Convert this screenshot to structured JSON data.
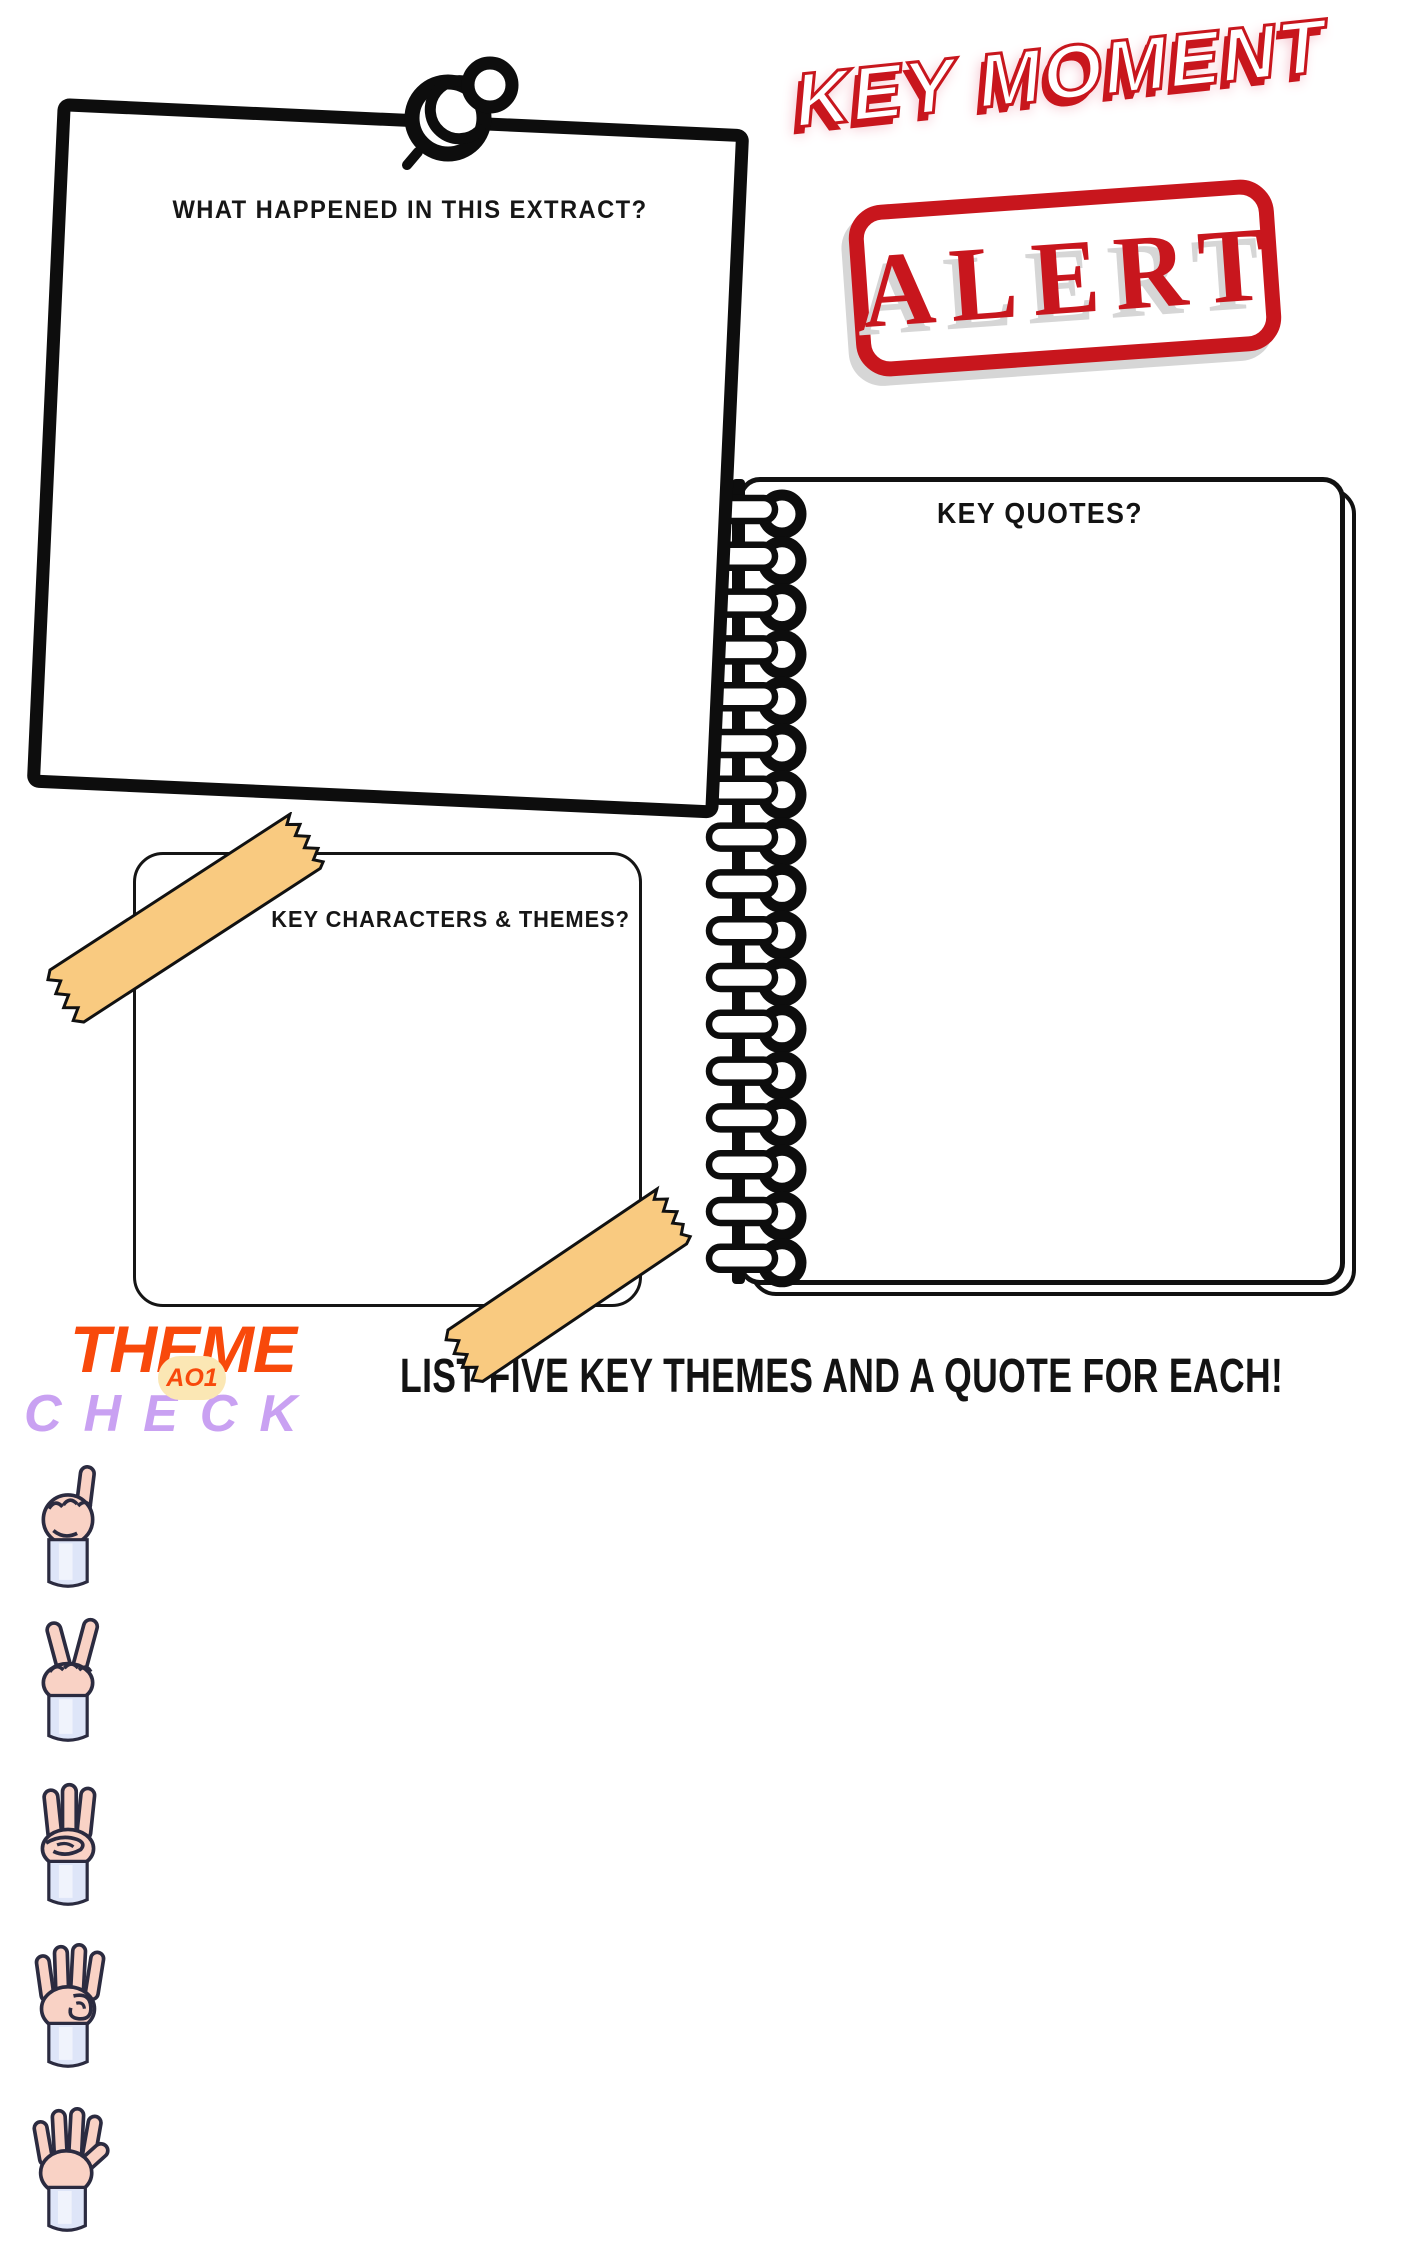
{
  "colors": {
    "red": "#c8161d",
    "stamp_shadow_gray": "#d6d6d6",
    "ink_black": "#0d0d0d",
    "tape_orange": "#f9ca80",
    "logo_orange": "#f8490b",
    "logo_purple": "#c9a1f2",
    "badge_cream": "#fbe7b4",
    "hand_skin": "#f9d2c5",
    "hand_sleeve": "#dee5f8",
    "hand_outline": "#2b2b40"
  },
  "extract_box": {
    "title": "WHAT HAPPENED IN THIS EXTRACT?"
  },
  "alert": {
    "heading": "KEY MOMENT",
    "stamp": "ALERT"
  },
  "notebook": {
    "title": "KEY QUOTES?"
  },
  "characters_box": {
    "title": "KEY CHARACTERS & THEMES?"
  },
  "theme_check": {
    "word_top": "THEME",
    "badge": "AO1",
    "word_bottom": "CHECK"
  },
  "instruction": "LIST FIVE KEY THEMES AND A QUOTE FOR EACH!",
  "hands": [
    {
      "icon": "hand-1-finger-icon",
      "fingers": 1
    },
    {
      "icon": "hand-2-fingers-icon",
      "fingers": 2
    },
    {
      "icon": "hand-3-fingers-icon",
      "fingers": 3
    },
    {
      "icon": "hand-4-fingers-icon",
      "fingers": 4
    },
    {
      "icon": "hand-5-fingers-icon",
      "fingers": 5
    }
  ]
}
